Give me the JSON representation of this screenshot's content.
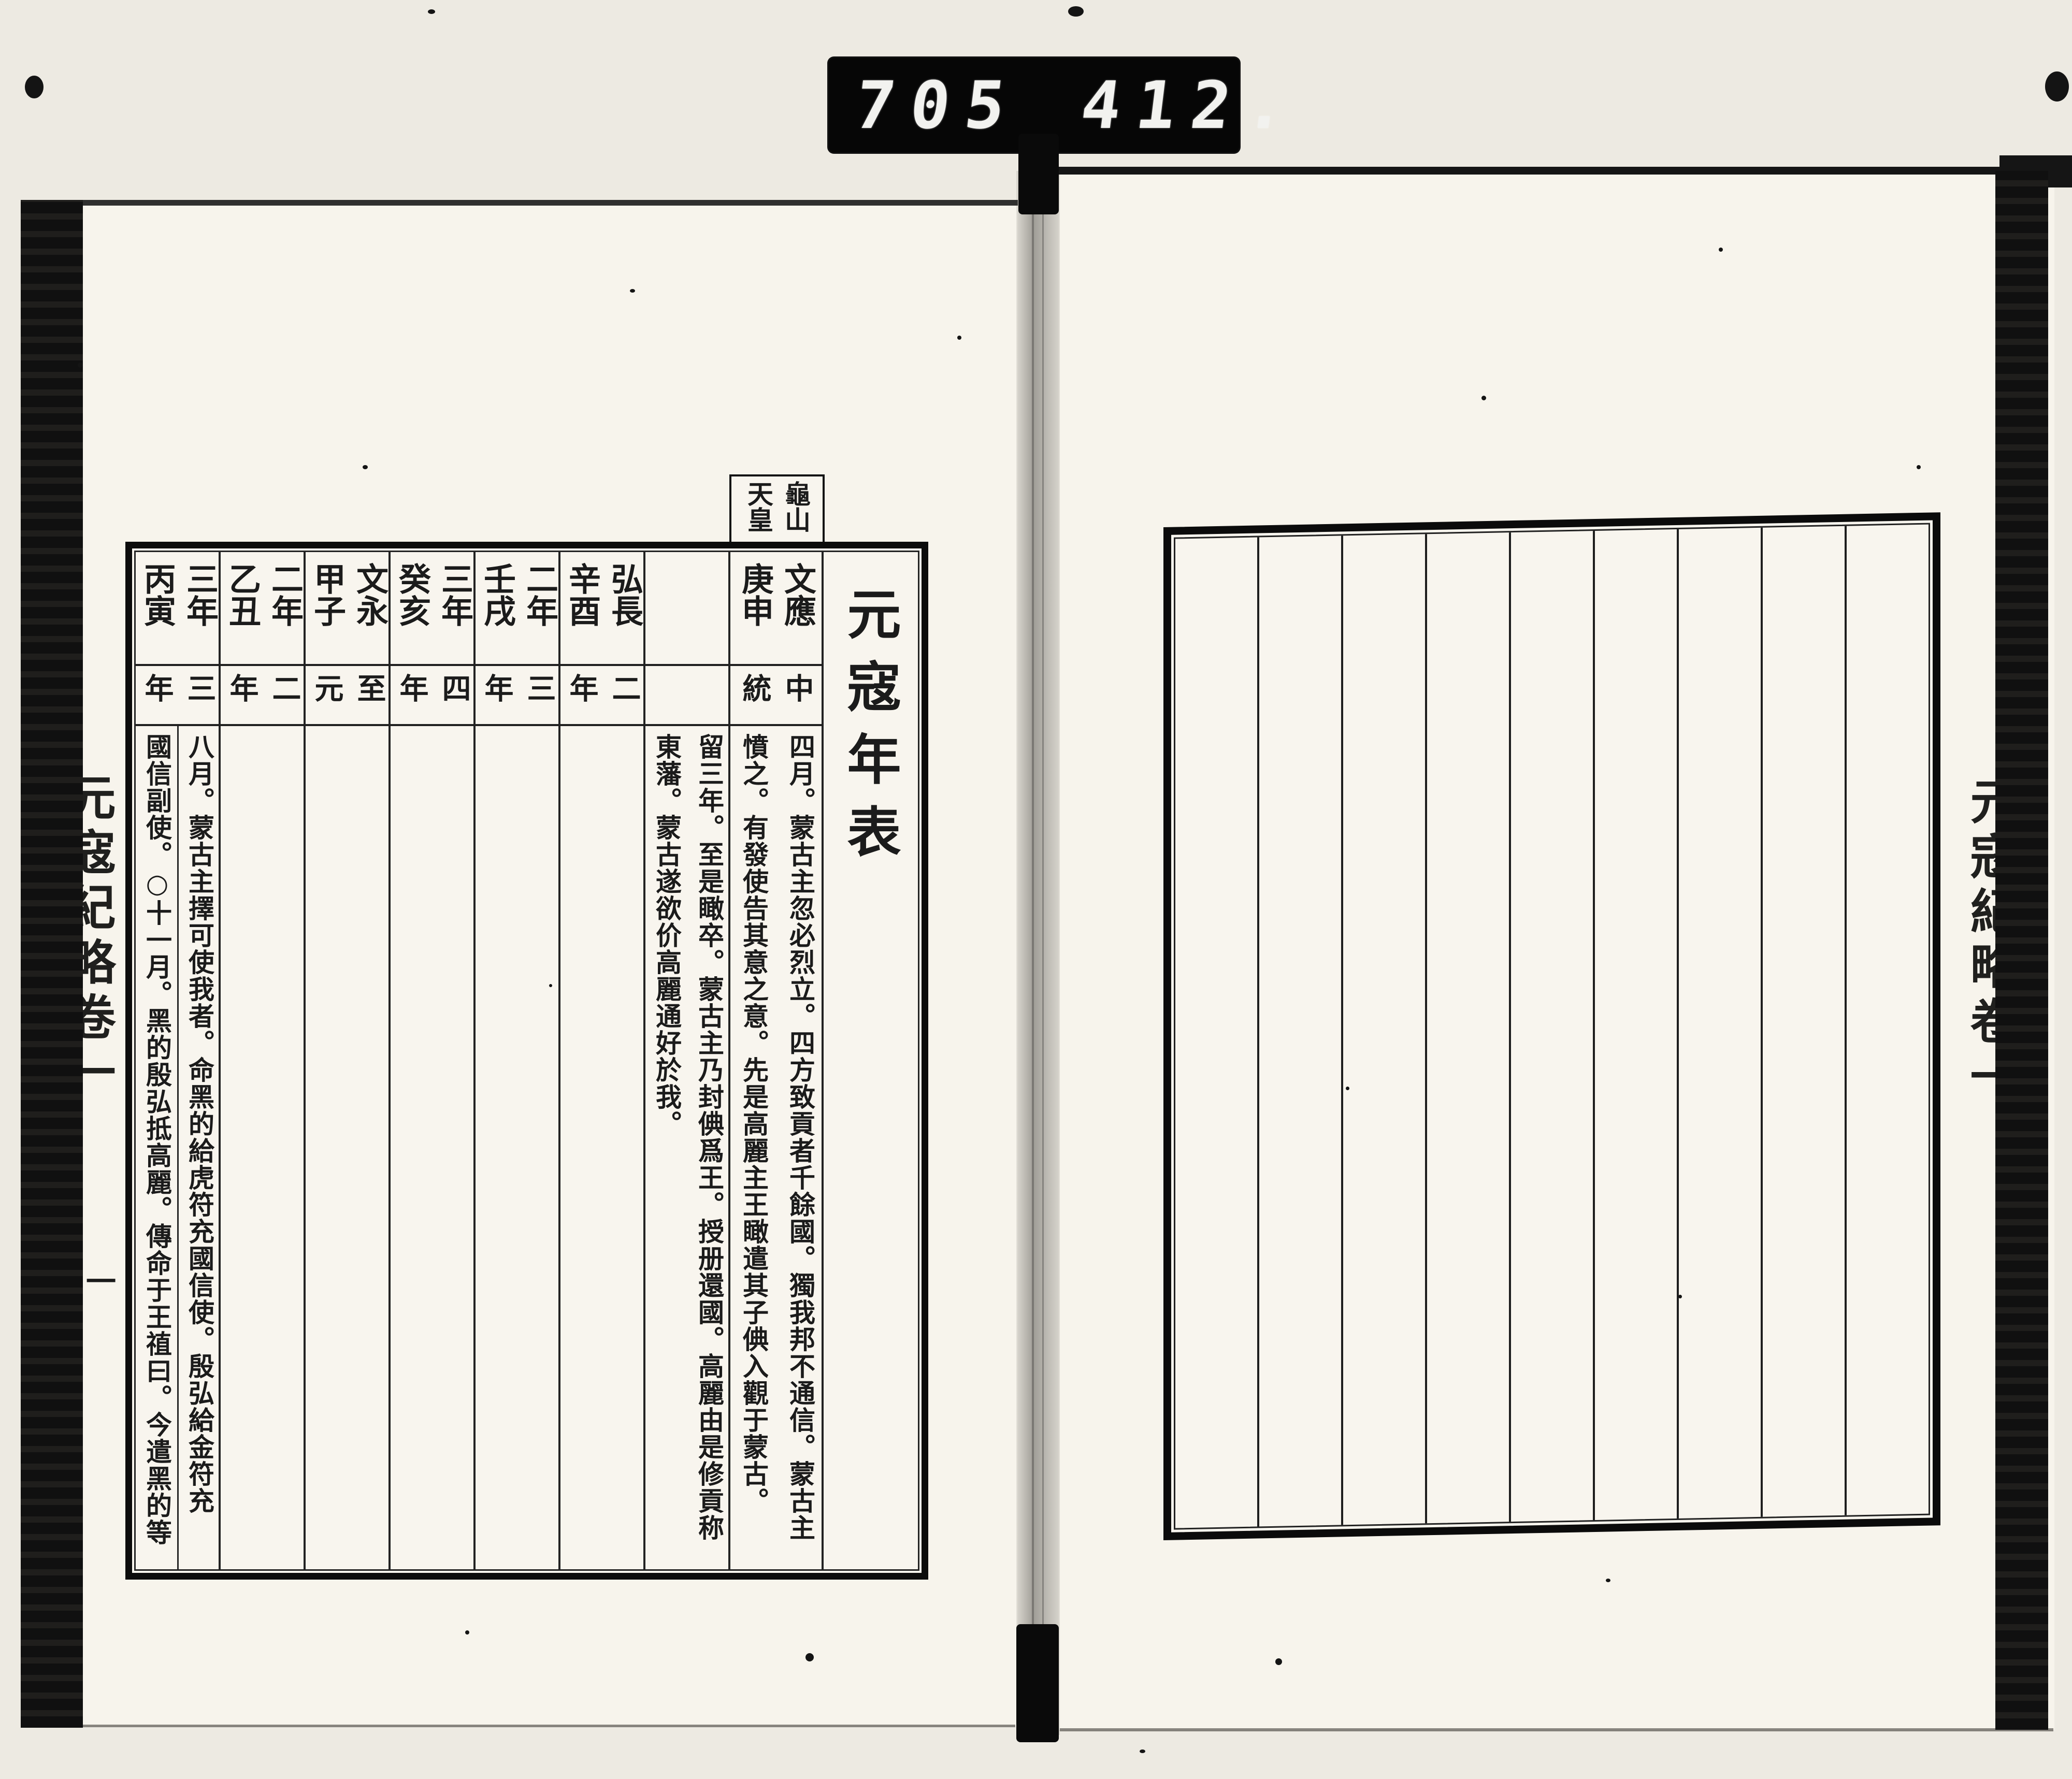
{
  "counter": {
    "left_digits": "705",
    "right_digits": "412."
  },
  "left_page": {
    "title": "元寇年表",
    "header_tab": "龜山\n天皇",
    "columns": [
      {
        "era": "三年\n丙寅",
        "cn_era": "三\n年",
        "body": "八月。蒙古主擇可使我者。命黑的給虎符充國信使。殷弘給金符充\n國信副使。○十一月。黑的殷弘抵高麗。傳命于王禃曰。今遣黑的等"
      },
      {
        "era": "二年\n乙丑",
        "cn_era": "二\n年",
        "body": ""
      },
      {
        "era": "文永\n甲子",
        "cn_era": "至\n元",
        "body": ""
      },
      {
        "era": "三年\n癸亥",
        "cn_era": "四\n年",
        "body": ""
      },
      {
        "era": "二年\n壬戌",
        "cn_era": "三\n年",
        "body": ""
      },
      {
        "era": "弘長\n辛酉",
        "cn_era": "二\n年",
        "body": ""
      },
      {
        "era": "",
        "cn_era": "",
        "body": "留三年。至是瞰卒。蒙古主乃封倎爲王。授册還國。高麗由是修貢称\n東藩。蒙古遂欲价高麗通好於我。"
      },
      {
        "era": "文應\n庚申",
        "cn_era": "中\n統",
        "body": "四月。蒙古主忽必烈立。四方致貢者千餘國。獨我邦不通信。蒙古主\n憤之。有發使告其意之意。先是高麗主王瞰遣其子倎入觀于蒙古。"
      }
    ],
    "spine_text": "元寇紀略卷一",
    "page_number": "一"
  },
  "right_page": {
    "column_count": 9,
    "spine_text": "元寇紀略卷一"
  }
}
